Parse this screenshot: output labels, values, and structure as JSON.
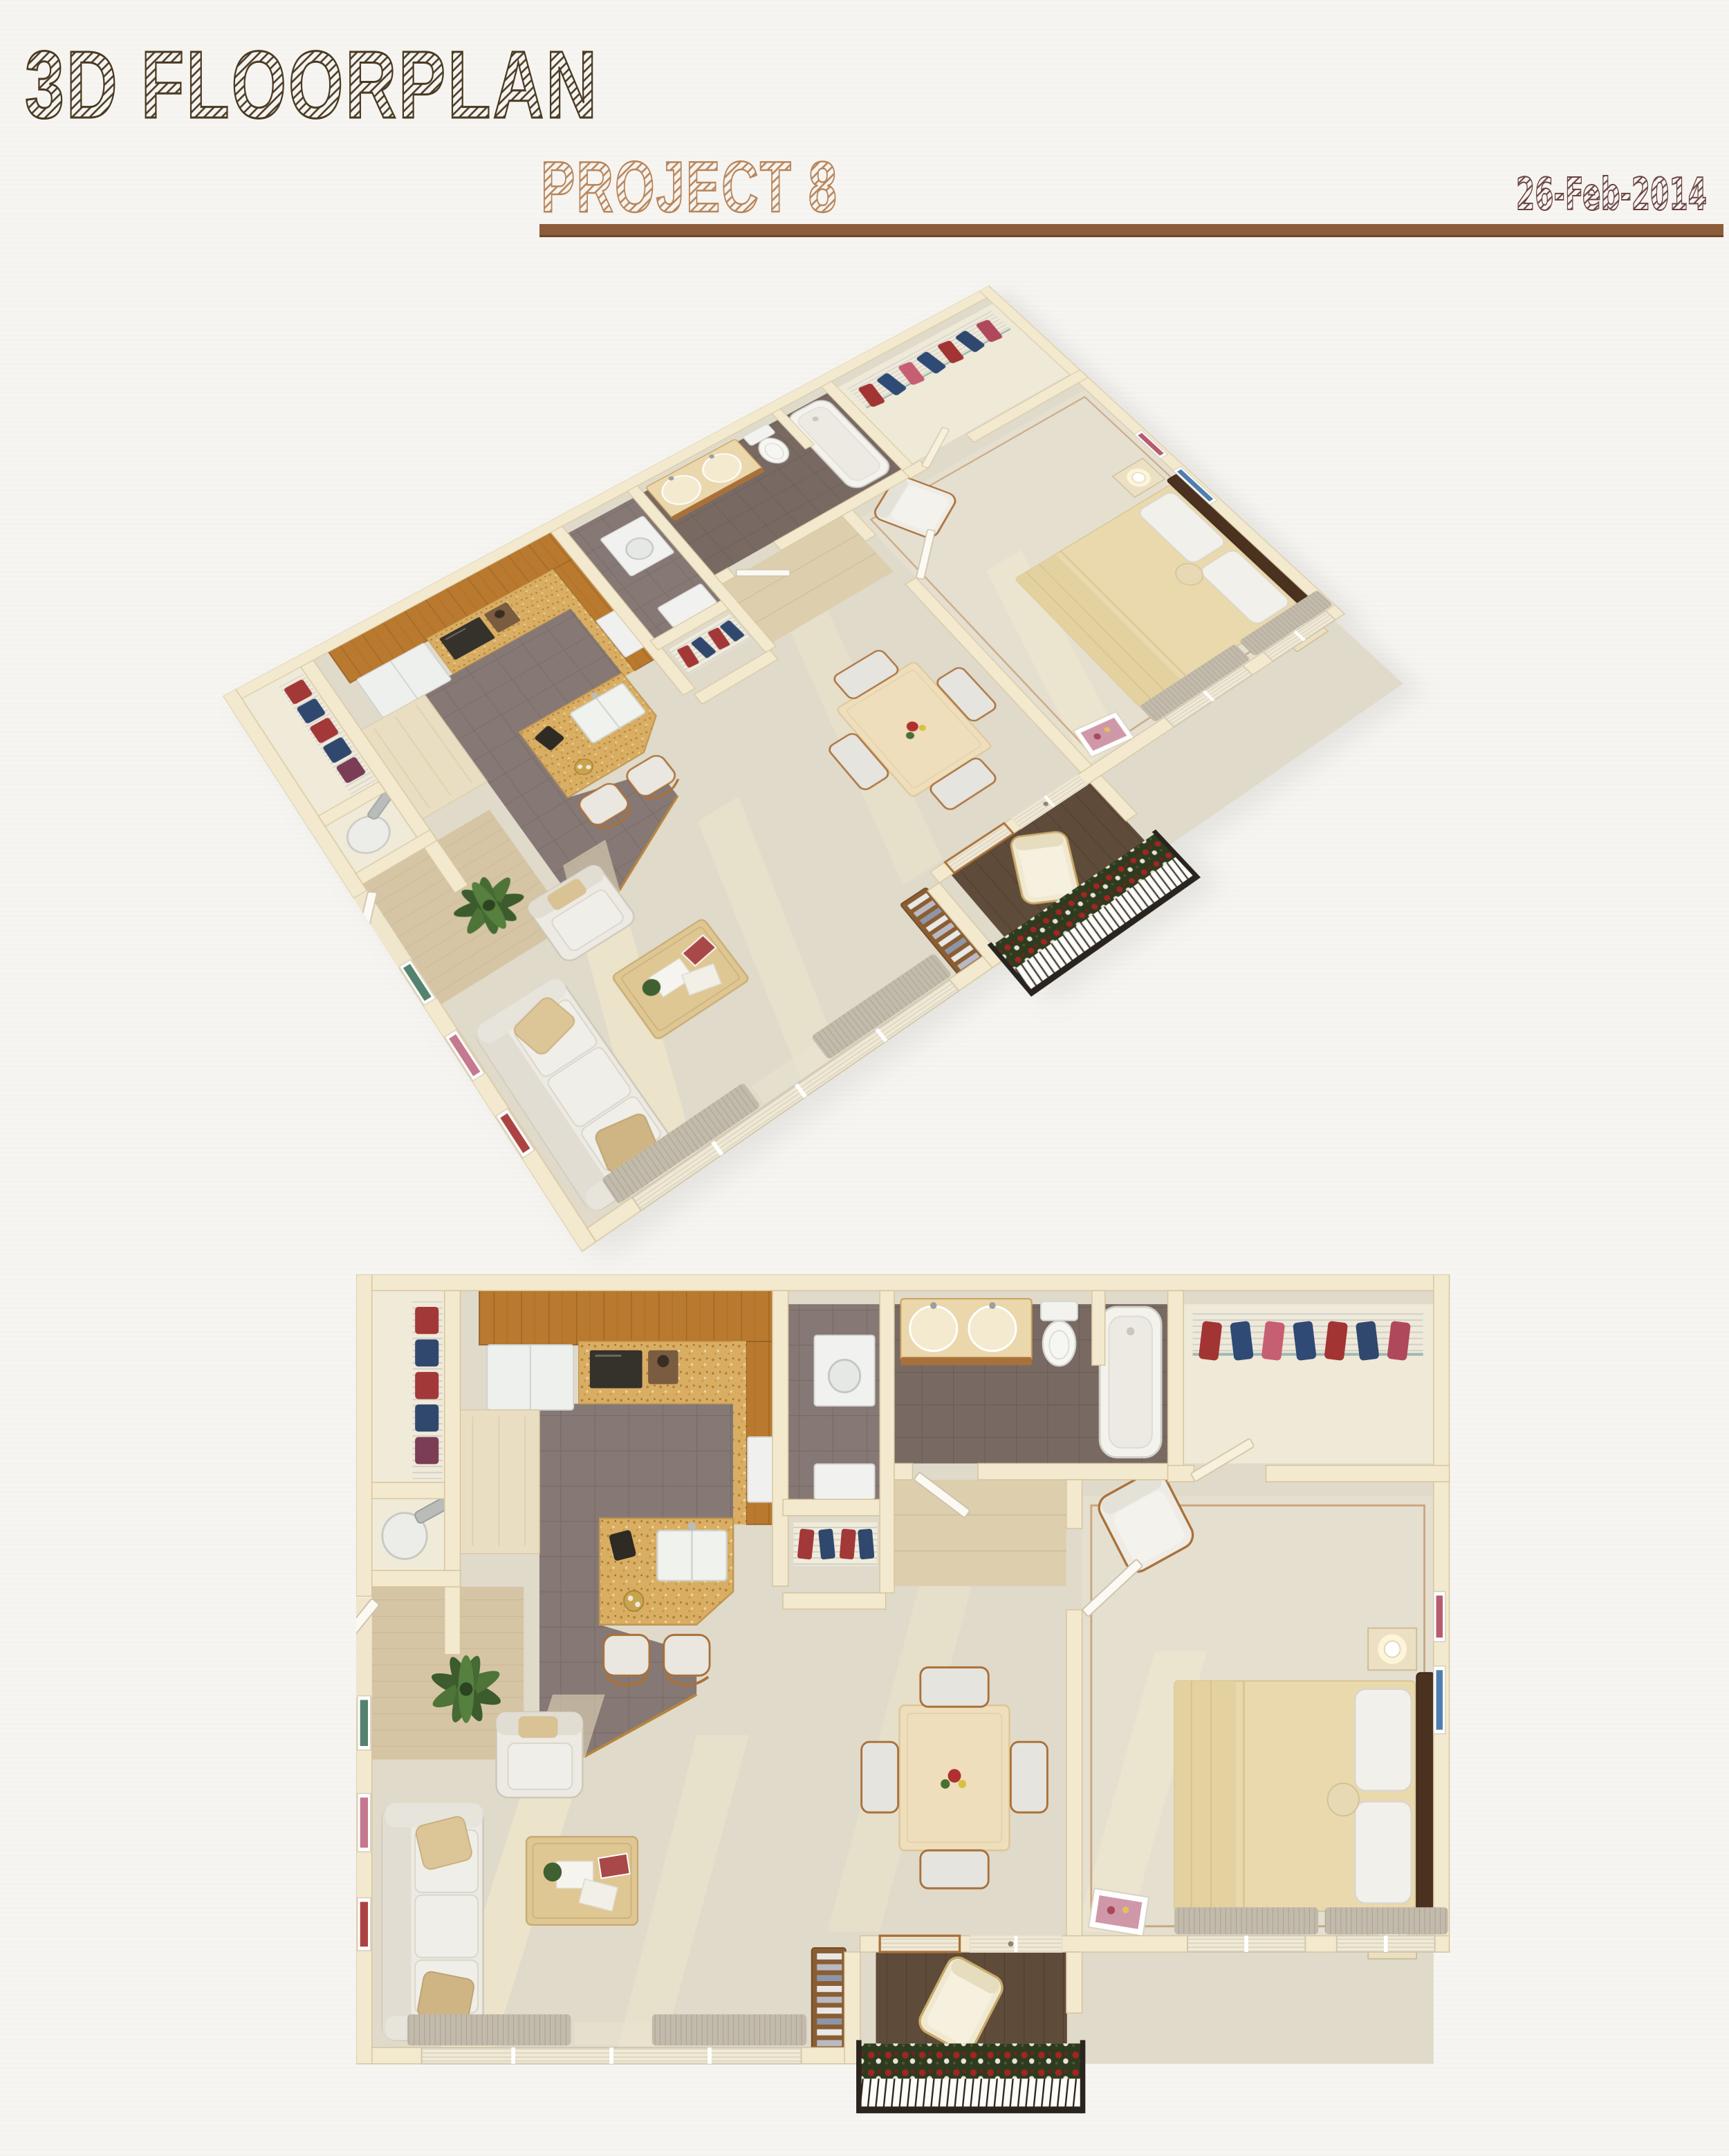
{
  "header": {
    "title": "3D FLOORPLAN",
    "project": "PROJECT 8",
    "date": "26-Feb-2014"
  },
  "accent_colors": {
    "title_ink": "#4a3a22",
    "project_tan": "#b9855a",
    "date_maroon": "#6b4340",
    "divider_brown": "#8d5c3a",
    "wall_cream": "#f3e9ce",
    "cabinet_wood": "#b9792e",
    "granite_tan": "#d9ae63",
    "floor_tile_gray": "#867874",
    "carpet_beige": "#e0dacb",
    "rose_red": "#a32424",
    "balcony_deck_brown": "#5f4b39"
  },
  "figures": [
    {
      "name": "isometric-3d-floorplan"
    },
    {
      "name": "top-down-floorplan"
    }
  ]
}
